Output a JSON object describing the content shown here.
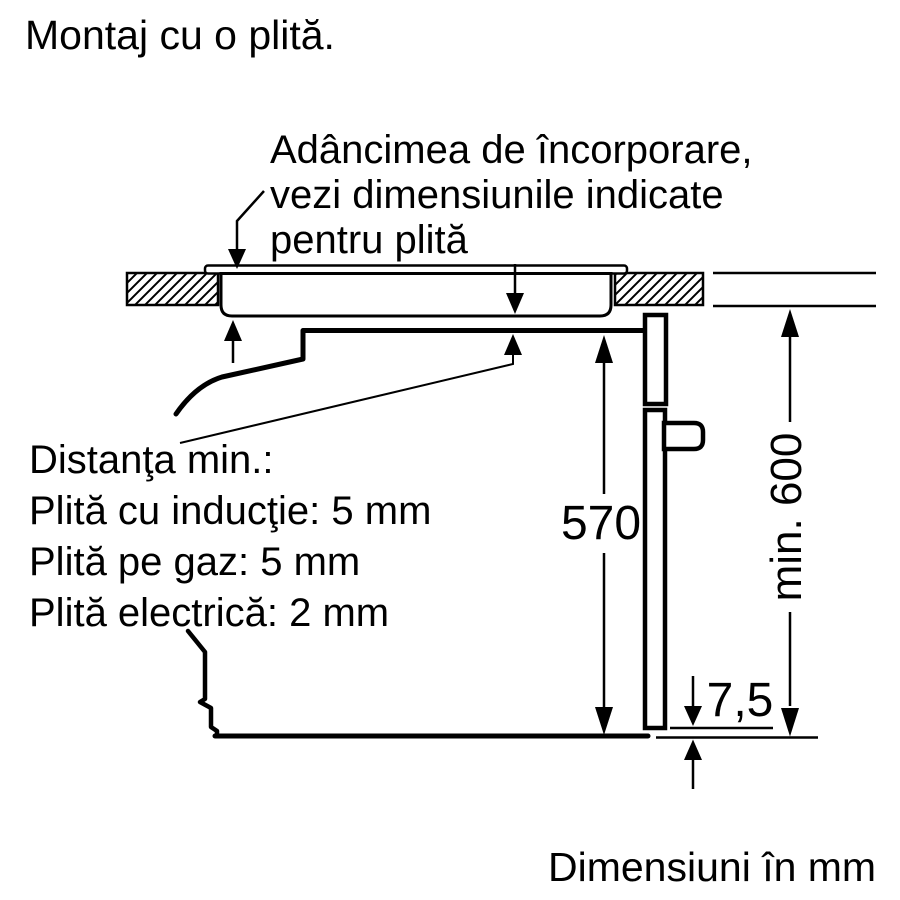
{
  "title": "Montaj cu o plită.",
  "annotation": {
    "line1": "Adâncimea de încorporare,",
    "line2": "vezi dimensiunile indicate",
    "line3": "pentru plită"
  },
  "min_distances": {
    "line1": "Distanţa min.:",
    "line2": "Plită cu inducţie: 5 mm",
    "line3": "Plită pe gaz: 5 mm",
    "line4": "Plită electrică: 2 mm"
  },
  "dimensions": {
    "oven_height_mm": "570",
    "min_niche_height": "min. 600",
    "bottom_gap_mm": "7,5"
  },
  "footer": "Dimensiuni în mm",
  "colors": {
    "line": "#000000",
    "background": "#ffffff"
  }
}
